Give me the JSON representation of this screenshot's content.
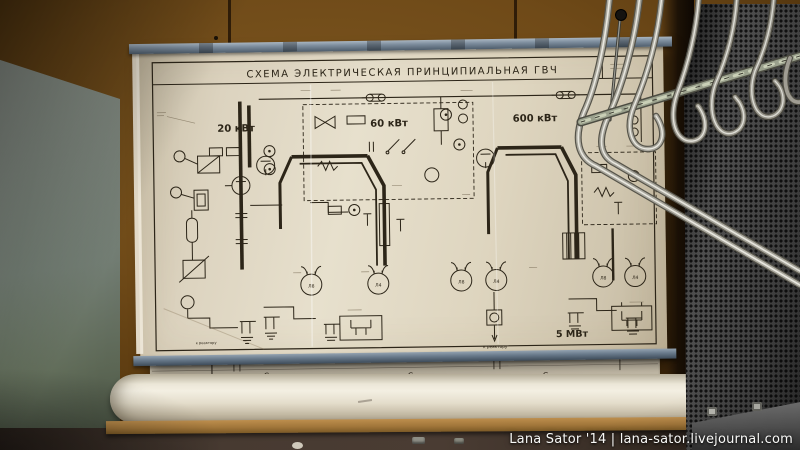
{
  "photo": {
    "watermark": "Lana Sator '14 | lana-sator.livejournal.com"
  },
  "poster": {
    "title": "СХЕМА ЭЛЕКТРИЧЕСКАЯ ПРИНЦИПИАЛЬНАЯ ГВЧ",
    "stage_labels": [
      "20 кВт",
      "60 кВт",
      "600 кВт"
    ],
    "output_label": "5 МВт",
    "reactor_note": "к реактору",
    "tube_labels": [
      "Л8",
      "Л4",
      "Л8",
      "Л4",
      "Л8",
      "Л4"
    ]
  },
  "lower_sheet": {
    "cap_labels": [
      "C₂",
      "C₄",
      "C₆"
    ]
  },
  "colors": {
    "wall": "#6f4a18",
    "side_panel": "#8b958b",
    "paper": "#ddd5c0",
    "ink": "#2c2518",
    "rail": "#7e8e9e",
    "mesh": "#3b3b3b",
    "roll": "#ece6d7",
    "shelf": "#a1763a",
    "chrome": "#aaa89e"
  }
}
